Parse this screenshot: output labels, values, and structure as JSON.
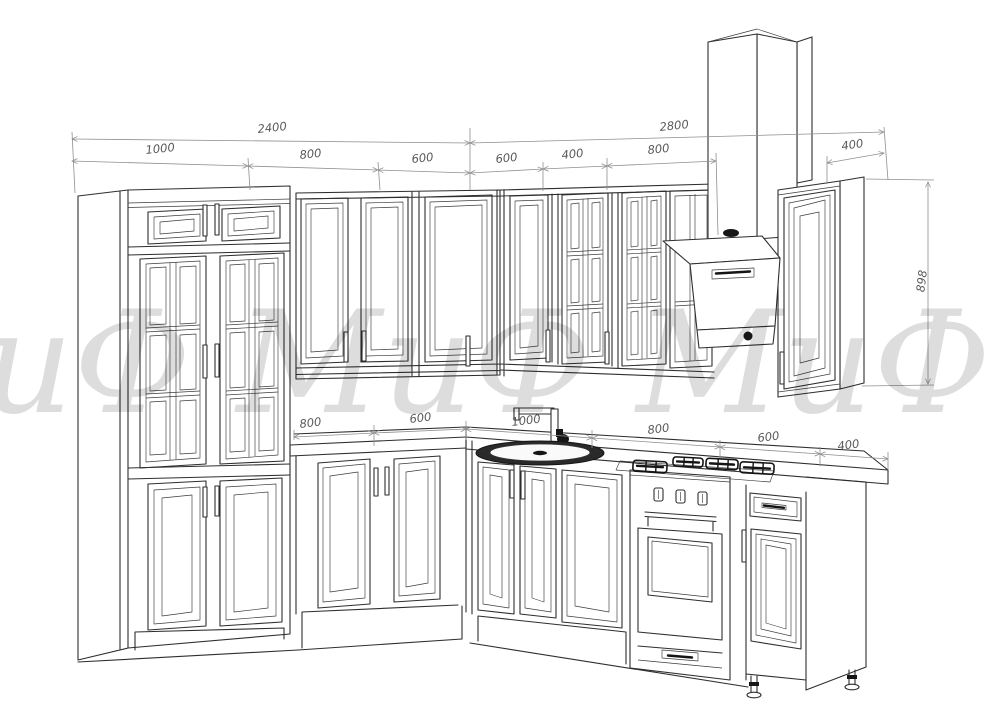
{
  "watermark": {
    "text": "иФ МиФ МиФ Ми"
  },
  "colors": {
    "background": "#ffffff",
    "line": "#2e2e2e",
    "dimension_line": "#8f8f8f",
    "dimension_text": "#5a5a5a",
    "dark_fill": "#161616"
  },
  "dimensions": {
    "top": {
      "left_total": "2400",
      "right_total": "2800",
      "left_segments": [
        "1000",
        "800",
        "600"
      ],
      "right_segments": [
        "600",
        "400",
        "800"
      ],
      "right_cabinet_width": "400"
    },
    "side": {
      "right_cabinet_height": "898"
    },
    "base": {
      "left_segments": [
        "800",
        "600"
      ],
      "right_segments": [
        "1000",
        "800",
        "600",
        "400"
      ]
    }
  },
  "parts": [
    "tall-cabinet",
    "upper-cabinets-left",
    "upper-cabinets-right",
    "hood-chimney",
    "cooker-hood",
    "right-wall-cabinet",
    "countertop",
    "kitchen-sink",
    "faucet",
    "gas-cooktop",
    "oven",
    "base-cabinets-left",
    "base-cabinets-right",
    "drawer-cabinet",
    "end-panel",
    "adjustable-legs"
  ]
}
